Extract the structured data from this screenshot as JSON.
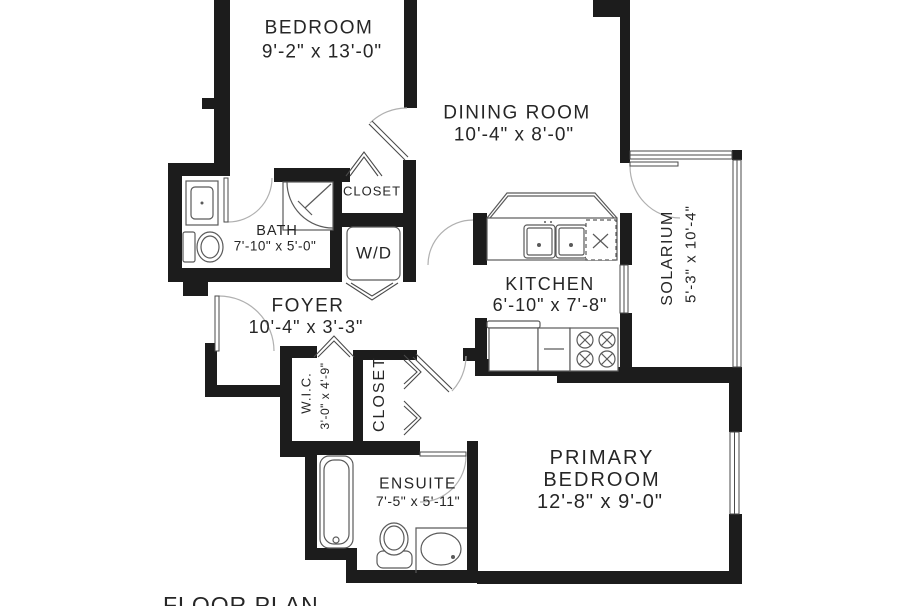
{
  "title": "FLOOR PLAN",
  "colors": {
    "wall": "#1c1c1c",
    "fixture_line": "#5a5a5a",
    "door_arc": "#b0b0b0",
    "text": "#262626",
    "background": "#ffffff"
  },
  "rooms": {
    "bedroom": {
      "name": "BEDROOM",
      "dims": "9'-2\" x 13'-0\""
    },
    "dining_room": {
      "name": "DINING ROOM",
      "dims": "10'-4\" x 8'-0\""
    },
    "closet_bedroom": {
      "name": "CLOSET"
    },
    "bath": {
      "name": "BATH",
      "dims": "7'-10\" x 5'-0\""
    },
    "laundry": {
      "name": "W/D"
    },
    "foyer": {
      "name": "FOYER",
      "dims": "10'-4\" x 3'-3\""
    },
    "kitchen": {
      "name": "KITCHEN",
      "dims": "6'-10\" x 7'-8\""
    },
    "solarium": {
      "name": "SOLARIUM",
      "dims": "5'-3\" x 10'-4\""
    },
    "wic": {
      "name": "W.I.C.",
      "dims": "3'-0\" x 4'-9\""
    },
    "closet_hall": {
      "name": "CLOSET"
    },
    "ensuite": {
      "name": "ENSUITE",
      "dims": "7'-5\" x 5'-11\""
    },
    "primary_bedroom": {
      "line1": "PRIMARY",
      "line2": "BEDROOM",
      "dims": "12'-8\" x 9'-0\""
    }
  }
}
